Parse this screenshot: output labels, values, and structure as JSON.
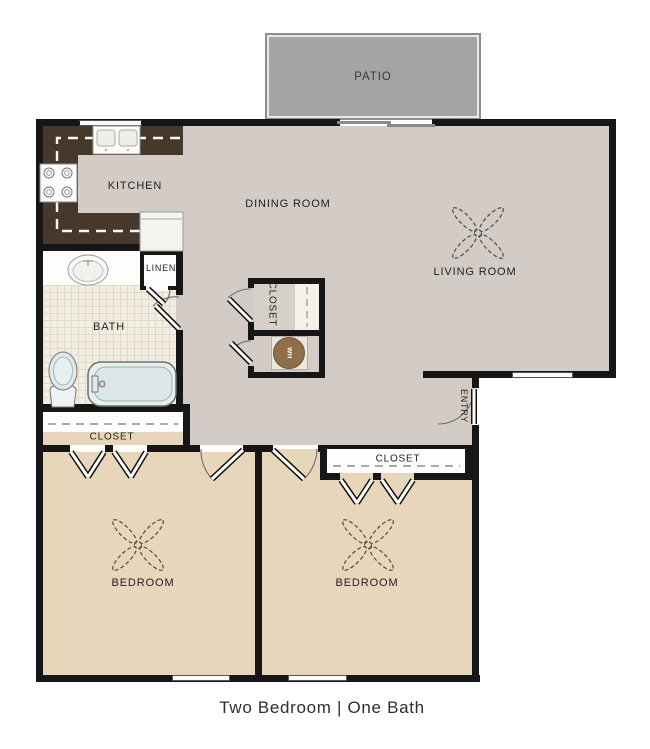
{
  "caption": "Two Bedroom | One Bath",
  "rooms": {
    "patio": "PATIO",
    "kitchen": "KITCHEN",
    "dining_room": "DINING ROOM",
    "living_room": "LIVING ROOM",
    "bath": "BATH",
    "linen_closet": "LINEN",
    "hall_closet": "CLOSET",
    "water_heater": "WH",
    "entry": "ENTRY",
    "bedroom_left": "BEDROOM",
    "bedroom_right": "BEDROOM",
    "bedroom_left_closet": "CLOSET",
    "bedroom_right_closet": "CLOSET"
  },
  "colors": {
    "wall": "#161616",
    "floor_main": "#d3ccc6",
    "floor_bedroom": "#e8d6ba",
    "kitchen_counter": "#46392c",
    "bath_tile": "#f3eee3",
    "patio_concrete": "#a4a4a2",
    "water_heater_tank": "#8f6f48",
    "tub_fill": "#dce8e8"
  }
}
